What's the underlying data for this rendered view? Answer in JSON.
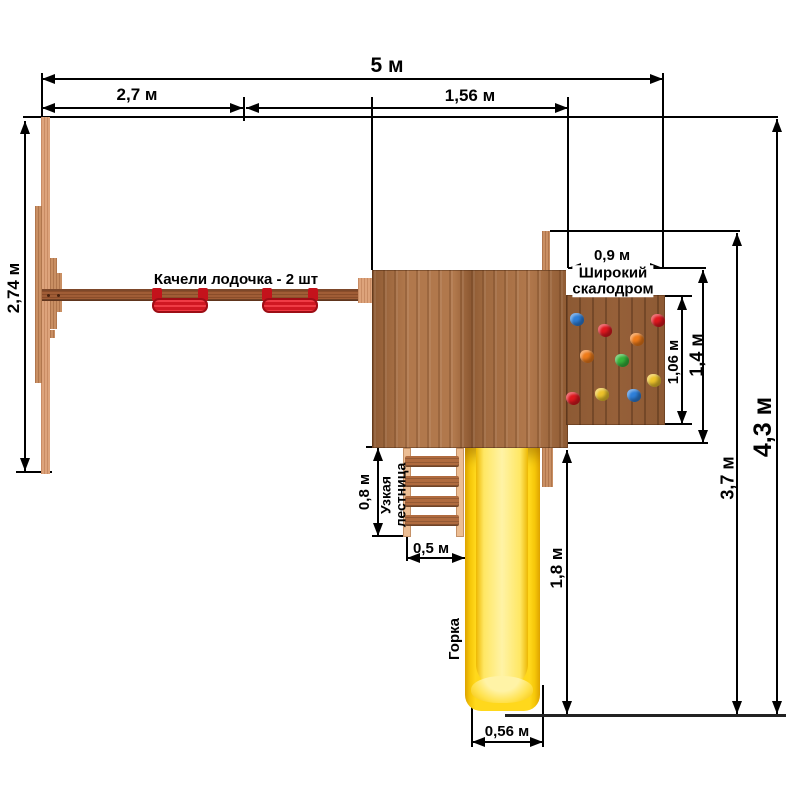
{
  "diagram": {
    "dimensions": {
      "total_width": "5 м",
      "swing_section_width": "2,7 м",
      "platform_section_width": "1,56 м",
      "swing_frame_depth": "2,74 м",
      "climbwall_width": "0,9 м",
      "climbwall_inner_height": "1,06 м",
      "climbwall_height": "1,4 м",
      "depth_to_rear_post": "3,7 м",
      "total_depth": "4,3 м",
      "ladder_length": "0,8 м",
      "ladder_width": "0,5 м",
      "slide_length": "1,8 м",
      "slide_width": "0,56 м"
    },
    "annotations": {
      "swings": "Качели лодочка - 2 шт",
      "climbwall_line1": "Широкий",
      "climbwall_line2": "скалодром",
      "ladder_line1": "Узкая",
      "ladder_line2": "лестница",
      "slide": "Горка"
    },
    "colors": {
      "wood_light": "#dda37b",
      "wood_plank": "#c98f63",
      "wood_beam": "#a05d36",
      "wood_platform": "#b1784c",
      "wood_platform_dark": "#8e5a33",
      "wood_wall": "#8d5a34",
      "wood_rung": "#b06b3f",
      "wood_rail_light": "#ecbd93",
      "swing_red": "#d01722",
      "swing_red_dark": "#c4121b",
      "slide_yellow": "#ffd81c",
      "dim_line": "#000000",
      "ground_line": "#222222"
    },
    "hold_colors": {
      "blue": "#2e7fd9",
      "red": "#e0181f",
      "orange": "#ef7c1a",
      "green": "#36b53a",
      "yellow": "#edc32b"
    },
    "holds": [
      {
        "color": "blue",
        "x": 4,
        "y": 18
      },
      {
        "color": "red",
        "x": 32,
        "y": 29
      },
      {
        "color": "red",
        "x": 85,
        "y": 19
      },
      {
        "color": "orange",
        "x": 64,
        "y": 38
      },
      {
        "color": "orange",
        "x": 14,
        "y": 55
      },
      {
        "color": "green",
        "x": 49,
        "y": 59
      },
      {
        "color": "yellow",
        "x": 81,
        "y": 79
      },
      {
        "color": "yellow",
        "x": 29,
        "y": 93
      },
      {
        "color": "blue",
        "x": 61,
        "y": 94
      },
      {
        "color": "red",
        "x": 0,
        "y": 97
      }
    ]
  }
}
